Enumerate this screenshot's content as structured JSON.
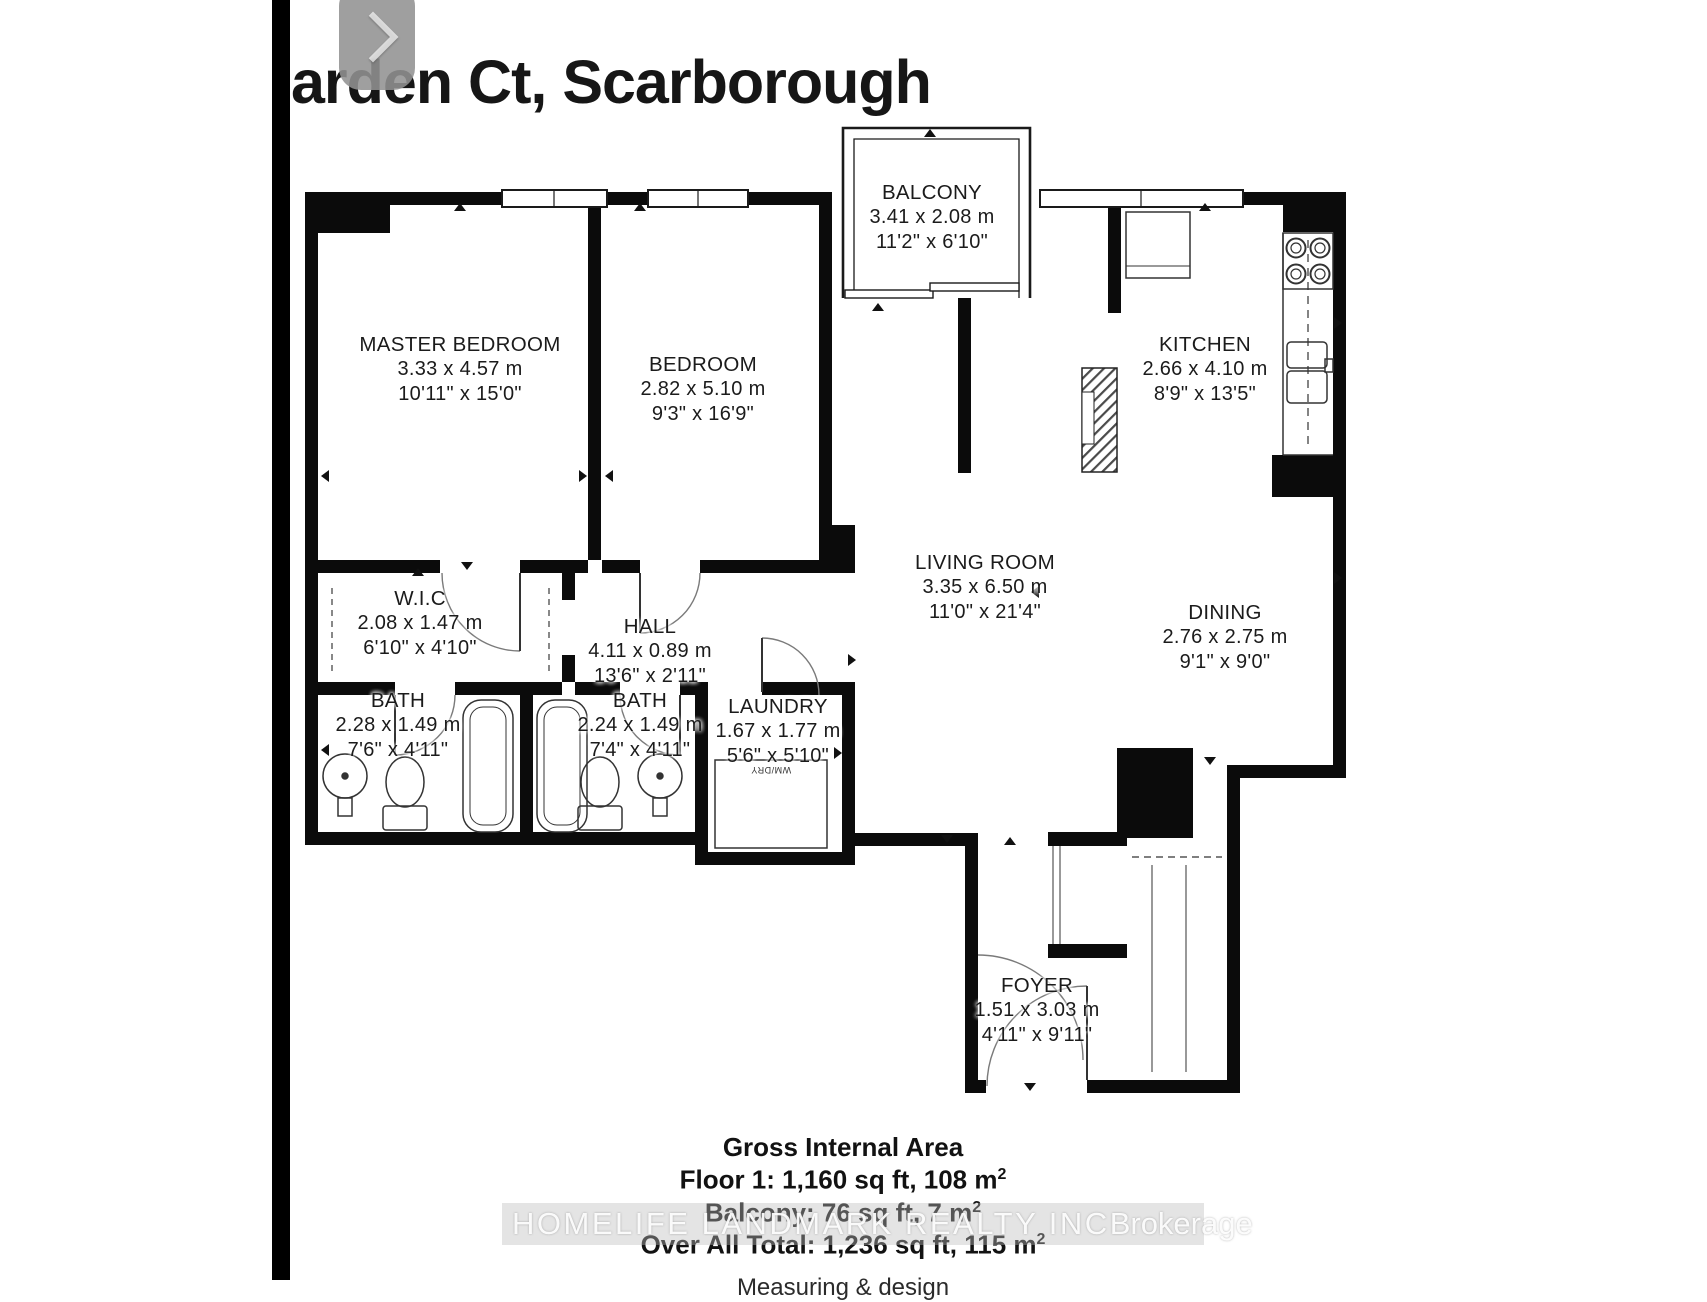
{
  "header": {
    "title": "arden Ct, Scarborough"
  },
  "rooms": {
    "master": {
      "name": "MASTER BEDROOM",
      "metric": "3.33 x 4.57 m",
      "imperial": "10'11\" x 15'0\""
    },
    "bedroom": {
      "name": "BEDROOM",
      "metric": "2.82 x 5.10 m",
      "imperial": "9'3\" x 16'9\""
    },
    "balcony": {
      "name": "BALCONY",
      "metric": "3.41 x 2.08 m",
      "imperial": "11'2\" x 6'10\""
    },
    "kitchen": {
      "name": "KITCHEN",
      "metric": "2.66 x 4.10 m",
      "imperial": "8'9\" x 13'5\""
    },
    "living": {
      "name": "LIVING ROOM",
      "metric": "3.35 x 6.50 m",
      "imperial": "11'0\" x 21'4\""
    },
    "dining": {
      "name": "DINING",
      "metric": "2.76 x 2.75 m",
      "imperial": "9'1\" x 9'0\""
    },
    "wic": {
      "name": "W.I.C",
      "metric": "2.08 x 1.47 m",
      "imperial": "6'10\" x 4'10\""
    },
    "hall": {
      "name": "HALL",
      "metric": "4.11 x 0.89 m",
      "imperial": "13'6\" x 2'11\""
    },
    "bath1": {
      "name": "BATH",
      "metric": "2.28 x 1.49 m",
      "imperial": "7'6\" x 4'11\""
    },
    "bath2": {
      "name": "BATH",
      "metric": "2.24 x 1.49 m",
      "imperial": "7'4\" x 4'11\""
    },
    "laundry": {
      "name": "LAUNDRY",
      "metric": "1.67 x 1.77 m",
      "imperial": "5'6\" x 5'10\""
    },
    "foyer": {
      "name": "FOYER",
      "metric": "1.51 x 3.03 m",
      "imperial": "4'11\" x 9'11\""
    }
  },
  "appliances": {
    "washer_dryer": "WM/DRY"
  },
  "summary": {
    "heading": "Gross Internal Area",
    "floor1": "Floor 1: 1,160 sq ft, 108 m",
    "balcony": "Balcony: 76 sq ft, 7 m",
    "total": "Over All Total: 1,236 sq ft, 115 m",
    "sup": "2",
    "credit": "Measuring & design"
  },
  "watermark": {
    "brand": "HOMELIFE LANDMARK REALTY INC",
    "suffix": "Brokerage"
  },
  "colors": {
    "wall": "#0b0b0b",
    "line": "#333333",
    "arc": "#777777",
    "button": "#929292"
  }
}
